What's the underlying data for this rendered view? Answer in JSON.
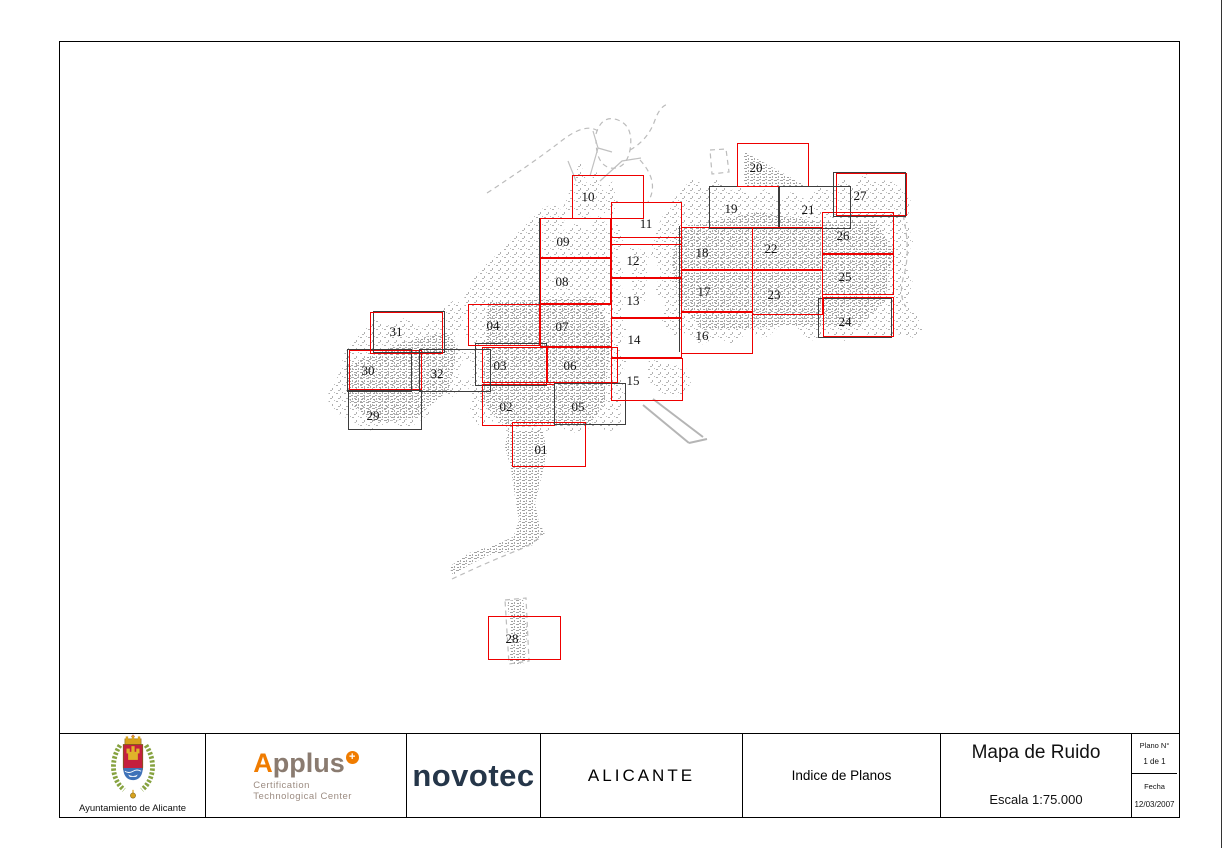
{
  "title_block": {
    "municipality_caption": "Ayuntamiento de Alicante",
    "applus": {
      "brand_a": "A",
      "brand_rest": "pplus",
      "badge": "+",
      "line1": "Certification",
      "line2": "Technological Center"
    },
    "novotec_brand": "novotec",
    "city": "ALICANTE",
    "sheet_index_label": "Indice de Planos",
    "map_title": "Mapa de Ruido",
    "scale": "Escala 1:75.000",
    "plano_no_label": "Plano N°",
    "plano_no_value": "1 de 1",
    "fecha_label": "Fecha",
    "fecha_value": "12/03/2007"
  },
  "colors": {
    "sheet_red": "#ee0000",
    "sheet_black": "#3d3d3d",
    "fabric_gray": "#ababab",
    "boundary_dash": "#bcbcbc"
  },
  "map": {
    "sheets": [
      {
        "label": "01",
        "x": 512,
        "y": 422,
        "w": 74,
        "h": 45,
        "color": "red",
        "lx": 541,
        "ly": 450
      },
      {
        "label": "02",
        "x": 482,
        "y": 384,
        "w": 73,
        "h": 42,
        "color": "red",
        "lx": 506,
        "ly": 407
      },
      {
        "label": "03",
        "x": 482,
        "y": 347,
        "w": 65,
        "h": 36,
        "color": "red",
        "lx": 500,
        "ly": 366
      },
      {
        "label": "04",
        "x": 468,
        "y": 304,
        "w": 72,
        "h": 42,
        "color": "red",
        "lx": 493,
        "ly": 326
      },
      {
        "label": "05",
        "x": 554,
        "y": 383,
        "w": 72,
        "h": 42,
        "color": "black",
        "lx": 578,
        "ly": 407
      },
      {
        "label": "06",
        "x": 547,
        "y": 347,
        "w": 71,
        "h": 36,
        "color": "red",
        "lx": 570,
        "ly": 366
      },
      {
        "label": "07",
        "x": 540,
        "y": 304,
        "w": 72,
        "h": 43,
        "color": "red",
        "lx": 562,
        "ly": 327
      },
      {
        "label": "08",
        "x": 540,
        "y": 258,
        "w": 71,
        "h": 46,
        "color": "red",
        "lx": 562,
        "ly": 282
      },
      {
        "label": "09",
        "x": 540,
        "y": 218,
        "w": 71,
        "h": 40,
        "color": "red",
        "lx": 563,
        "ly": 242
      },
      {
        "label": "10",
        "x": 572,
        "y": 175,
        "w": 72,
        "h": 44,
        "color": "red",
        "lx": 588,
        "ly": 197
      },
      {
        "label": "11",
        "x": 611,
        "y": 202,
        "w": 71,
        "h": 43,
        "color": "red",
        "lx": 646,
        "ly": 224
      },
      {
        "label": "12",
        "x": 611,
        "y": 237,
        "w": 71,
        "h": 41,
        "color": "red",
        "lx": 633,
        "ly": 261
      },
      {
        "label": "13",
        "x": 611,
        "y": 278,
        "w": 71,
        "h": 40,
        "color": "red",
        "lx": 633,
        "ly": 301
      },
      {
        "label": "14",
        "x": 611,
        "y": 318,
        "w": 71,
        "h": 40,
        "color": "red",
        "lx": 634,
        "ly": 340
      },
      {
        "label": "15",
        "x": 611,
        "y": 358,
        "w": 72,
        "h": 43,
        "color": "red",
        "lx": 633,
        "ly": 381
      },
      {
        "label": "16",
        "x": 681,
        "y": 312,
        "w": 72,
        "h": 42,
        "color": "red",
        "lx": 702,
        "ly": 336
      },
      {
        "label": "17",
        "x": 681,
        "y": 270,
        "w": 72,
        "h": 42,
        "color": "red",
        "lx": 704,
        "ly": 292
      },
      {
        "label": "18",
        "x": 681,
        "y": 227,
        "w": 72,
        "h": 43,
        "color": "red",
        "lx": 702,
        "ly": 253
      },
      {
        "label": "19",
        "x": 709,
        "y": 186,
        "w": 70,
        "h": 43,
        "color": "black",
        "lx": 731,
        "ly": 209
      },
      {
        "label": "20",
        "x": 737,
        "y": 143,
        "w": 72,
        "h": 44,
        "color": "red",
        "lx": 756,
        "ly": 168
      },
      {
        "label": "21",
        "x": 779,
        "y": 186,
        "w": 72,
        "h": 43,
        "color": "black",
        "lx": 808,
        "ly": 210
      },
      {
        "label": "22",
        "x": 752,
        "y": 227,
        "w": 71,
        "h": 43,
        "color": "red",
        "lx": 771,
        "ly": 249
      },
      {
        "label": "23",
        "x": 752,
        "y": 270,
        "w": 71,
        "h": 45,
        "color": "red",
        "lx": 774,
        "ly": 295
      },
      {
        "label": "24",
        "x": 823,
        "y": 297,
        "w": 71,
        "h": 40,
        "color": "red",
        "lx": 845,
        "ly": 322
      },
      {
        "label": "25",
        "x": 822,
        "y": 254,
        "w": 72,
        "h": 41,
        "color": "red",
        "lx": 845,
        "ly": 277
      },
      {
        "label": "26",
        "x": 822,
        "y": 212,
        "w": 72,
        "h": 42,
        "color": "red",
        "lx": 843,
        "ly": 236
      },
      {
        "label": "27",
        "x": 833,
        "y": 172,
        "w": 73,
        "h": 45,
        "color": "black",
        "lx": 860,
        "ly": 196
      },
      {
        "label": "28",
        "x": 488,
        "y": 616,
        "w": 73,
        "h": 44,
        "color": "red",
        "lx": 512,
        "ly": 639
      },
      {
        "label": "29",
        "x": 348,
        "y": 390,
        "w": 74,
        "h": 40,
        "color": "black",
        "lx": 373,
        "ly": 416
      },
      {
        "label": "30",
        "x": 347,
        "y": 349,
        "w": 65,
        "h": 43,
        "color": "black",
        "lx": 368,
        "ly": 371
      },
      {
        "label": "31",
        "x": 370,
        "y": 312,
        "w": 73,
        "h": 42,
        "color": "red",
        "lx": 396,
        "ly": 332
      },
      {
        "label": "32",
        "x": 419,
        "y": 349,
        "w": 72,
        "h": 43,
        "color": "black",
        "lx": 437,
        "ly": 374
      }
    ],
    "companions": [
      {
        "x": 475,
        "y": 343,
        "w": 72,
        "h": 43,
        "color": "black"
      },
      {
        "x": 818,
        "y": 298,
        "w": 74,
        "h": 40,
        "color": "black"
      },
      {
        "x": 836,
        "y": 173,
        "w": 71,
        "h": 43,
        "color": "red"
      },
      {
        "x": 349,
        "y": 350,
        "w": 73,
        "h": 40,
        "color": "red"
      },
      {
        "x": 373,
        "y": 311,
        "w": 72,
        "h": 42,
        "color": "black"
      }
    ],
    "accent_lines": [
      {
        "x": 539,
        "y": 218,
        "h": 125
      },
      {
        "x": 679,
        "y": 226,
        "h": 126
      }
    ]
  }
}
